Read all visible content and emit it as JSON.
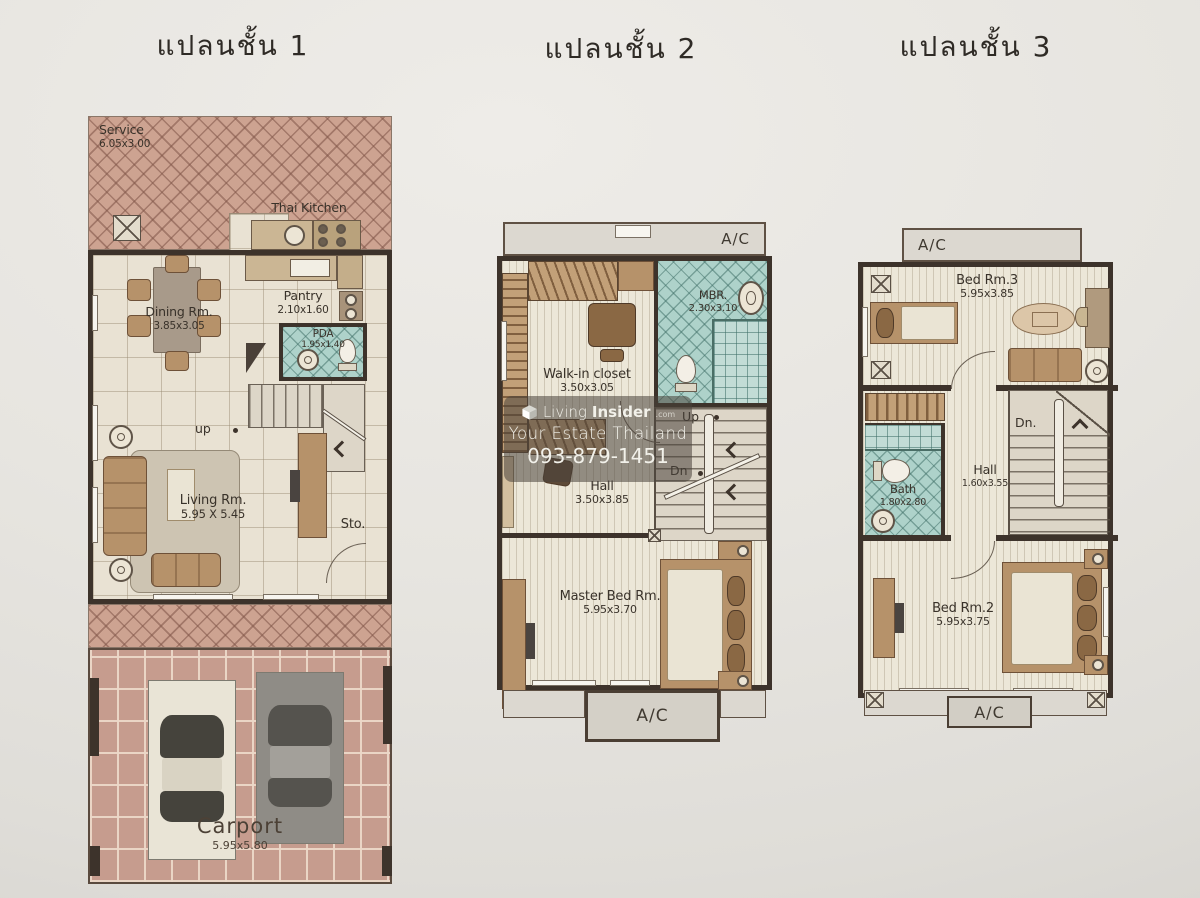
{
  "titles": {
    "floor1": "แปลนชั้น 1",
    "floor2": "แปลนชั้น 2",
    "floor3": "แปลนชั้น 3"
  },
  "floor1": {
    "service_name": "Service",
    "service_dims": "6.05x3.00",
    "thai_kitchen": "Thai Kitchen",
    "pantry_name": "Pantry",
    "pantry_dims": "2.10x1.60",
    "pda_name": "PDA",
    "pda_dims": "1.95x1.40",
    "dining_name": "Dining Rm.",
    "dining_dims": "3.85x3.05",
    "up": "up",
    "living_name": "Living Rm.",
    "living_dims": "5.95 X 5.45",
    "storage": "Sto.",
    "carport_name": "Carport",
    "carport_dims": "5.95x5.80"
  },
  "floor2": {
    "ac_top": "A/C",
    "ac_bottom": "A/C",
    "walkin_name": "Walk-in closet",
    "walkin_dims": "3.50x3.05",
    "mbr_name": "MBR.",
    "mbr_dims": "2.30x3.10",
    "up": "Up",
    "dn": "Dn",
    "hall_name": "Hall",
    "hall_dims": "3.50x3.85",
    "master_name": "Master Bed Rm.",
    "master_dims": "5.95x3.70"
  },
  "floor3": {
    "ac_top": "A/C",
    "ac_bottom": "A/C",
    "bed3_name": "Bed Rm.3",
    "bed3_dims": "5.95x3.85",
    "dn": "Dn.",
    "hall_name": "Hall",
    "hall_dims": "1.60x3.55",
    "bath_name": "Bath",
    "bath_dims": "1.80x2.80",
    "bed2_name": "Bed Rm.2",
    "bed2_dims": "5.95x3.75"
  },
  "watermark": {
    "brand_light": "Living",
    "brand_bold": "Insider",
    "brand_tld": ".com",
    "line2": "Your Estate Thailand",
    "phone": "093-879-1451"
  },
  "colors": {
    "wall": "#3d332b",
    "service_hatch": "#cda391",
    "bath_teal": "#aed2ca",
    "furniture_tan": "#b6926a",
    "carport_stone": "#c69c8e",
    "paper": "#e7e5e0"
  }
}
